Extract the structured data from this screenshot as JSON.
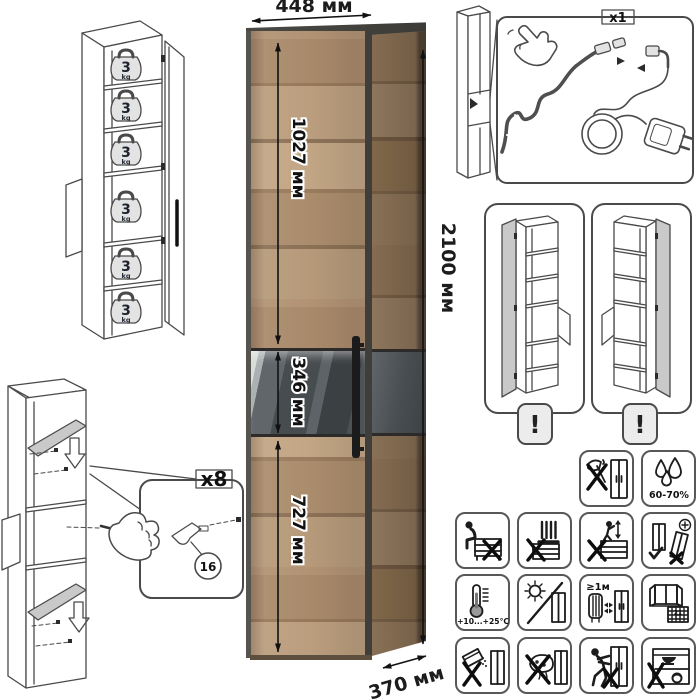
{
  "dimensions": {
    "width_label": "448 мм",
    "height_label": "2100 мм",
    "depth_label": "370 мм",
    "upper_door_label": "1027 мм",
    "display_section_label": "346 мм",
    "lower_door_label": "727 мм"
  },
  "shelf_capacity": {
    "value": "3",
    "unit": "kg",
    "shelves_marked": 6
  },
  "lighting_kit": {
    "quantity_label": "x1"
  },
  "assembly_step": {
    "quantity_label": "x8",
    "part_number": "16"
  },
  "door_variants": {
    "warning_symbol": "!",
    "count": 2
  },
  "care": {
    "humidity_range": "60-70%",
    "temperature_range": "+10...+25°C",
    "heater_distance": "≥1м",
    "calendar_day": "21",
    "icon_names": [
      "no-sharp-tools",
      "humidity-range",
      "no-sitting",
      "no-standing-on-top",
      "no-climbing",
      "level-adjustment-required",
      "temperature-range",
      "no-direct-sunlight",
      "keep-distance-from-heaters",
      "ventilate-room",
      "no-abrasive-cleaners",
      "no-wet-sponge",
      "do-not-push",
      "no-heavy-items-inside"
    ]
  },
  "colors": {
    "line_art": "#4a4a4a",
    "wood_mid": "#ab8e6c",
    "wood_dark": "#8c7257",
    "wood_light": "#c0a485",
    "frame_graphite": "#45443f",
    "glass_dark": "#404548",
    "shelf_gray": "#c9c9c9",
    "badge_gray": "#ececec"
  }
}
